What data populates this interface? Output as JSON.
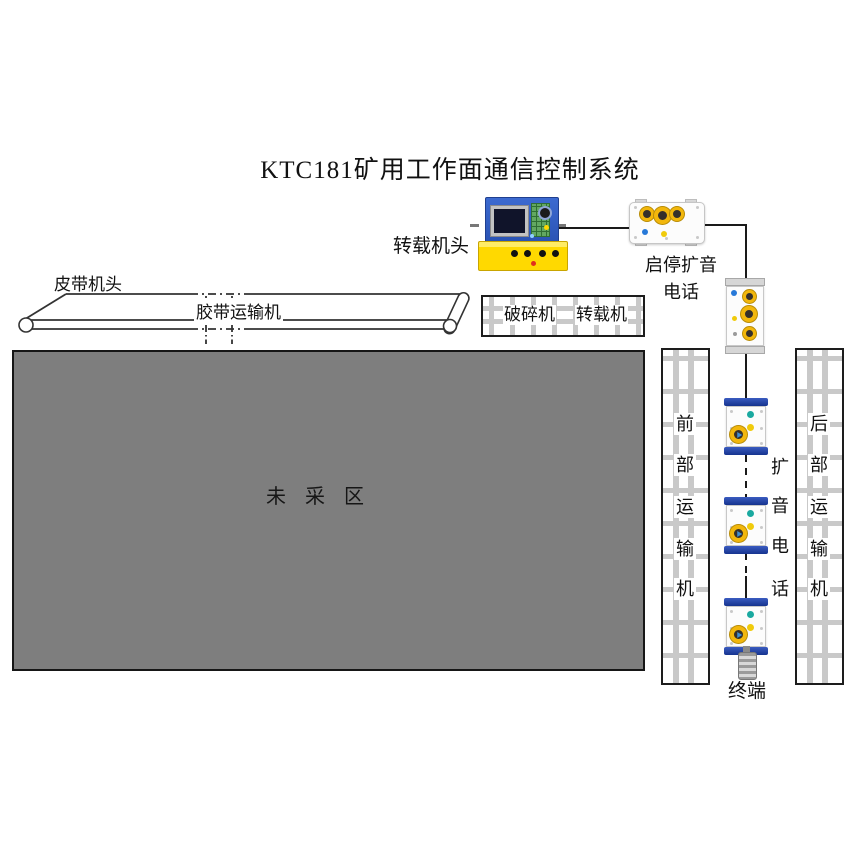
{
  "title": "KTC181矿用工作面通信控制系统",
  "diagram": {
    "transfer_head_label": "转载机头",
    "belt_head_label": "皮带机头",
    "belt_conveyor_label": "胶带运输机",
    "crusher_label": "破碎机",
    "transfer_machine_label": "转载机",
    "unmined_area_label": "未 采 区",
    "start_stop_phone_line1": "启停扩音",
    "start_stop_phone_line2": "电话",
    "front_conveyor_chars": [
      "前",
      "部",
      "运",
      "输",
      "机"
    ],
    "rear_conveyor_chars": [
      "后",
      "部",
      "运",
      "输",
      "机"
    ],
    "speaker_phone_chars": [
      "扩",
      "音",
      "电",
      "话"
    ],
    "terminal_label": "终端"
  },
  "icons": {
    "speaker_knob": "yellow-ring-round-knob",
    "indicator_dots": [
      "blue",
      "yellow",
      "teal"
    ],
    "control_screen": "dark-lcd-screen",
    "keypad": "green-button-grid"
  },
  "colors": {
    "panel_blue": "#2e5fc4",
    "device_yellow": "#ffd900",
    "knob_ring_yellow": "#f2b70c",
    "cap_navy": "#16348f",
    "teal_indicator": "#1aa9a0",
    "blue_indicator": "#2779d8",
    "yellow_indicator": "#f0cb0c",
    "unmined_gray": "#7e7e7e",
    "grid_bar_gray": "#c9c9c9",
    "wire_black": "#1a1a1a"
  }
}
